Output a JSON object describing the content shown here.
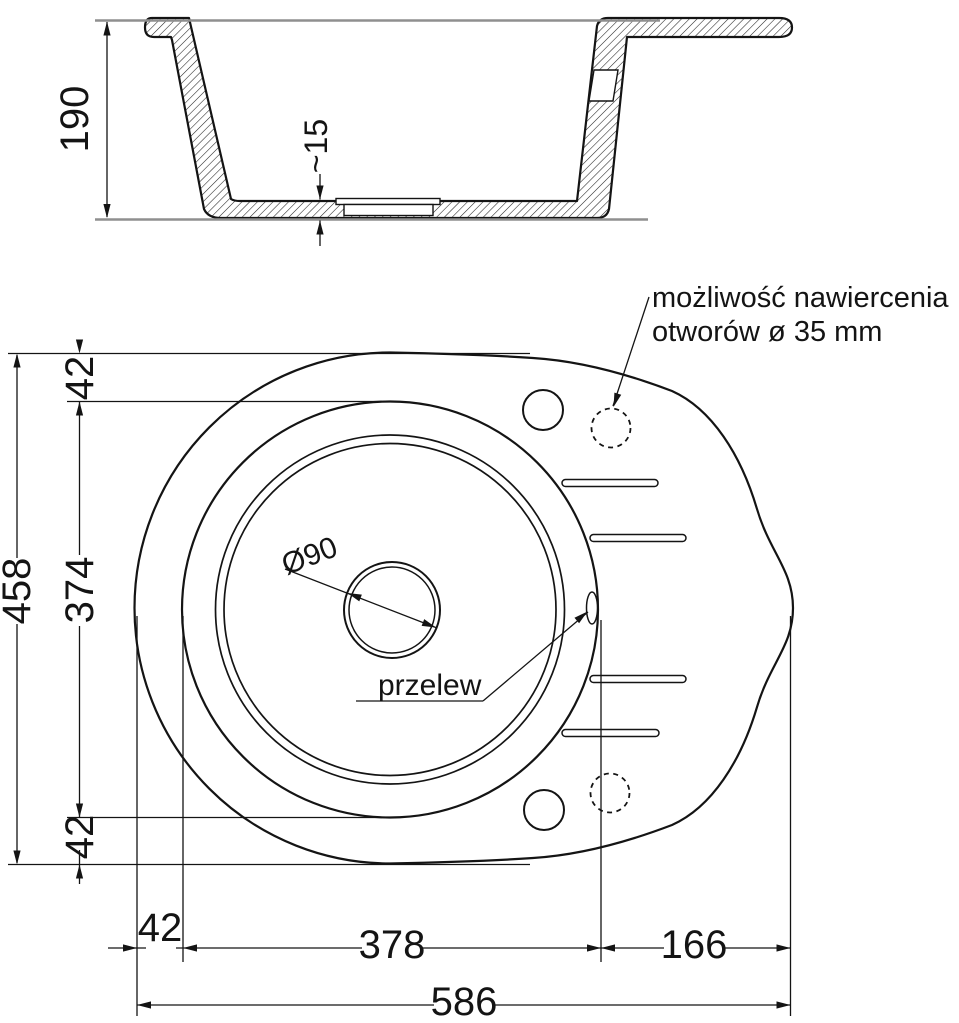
{
  "drawing": {
    "title": "sink-technical-drawing",
    "section": {
      "height": "190",
      "floor_thickness": "~15"
    },
    "plan": {
      "overall_height": "458",
      "top_offset": "42",
      "bowl_height": "374",
      "bottom_offset": "42",
      "left_offset": "42",
      "bowl_width": "378",
      "drainer_width": "166",
      "overall_width": "586",
      "drain_diameter": "Ø90",
      "overflow_label": "przelew",
      "note_line1": "możliwość nawiercenia",
      "note_line2": "otworów ø 35 mm"
    },
    "colors": {
      "line": "#141414",
      "reference_line": "#8f8f8f",
      "background": "#ffffff"
    }
  }
}
